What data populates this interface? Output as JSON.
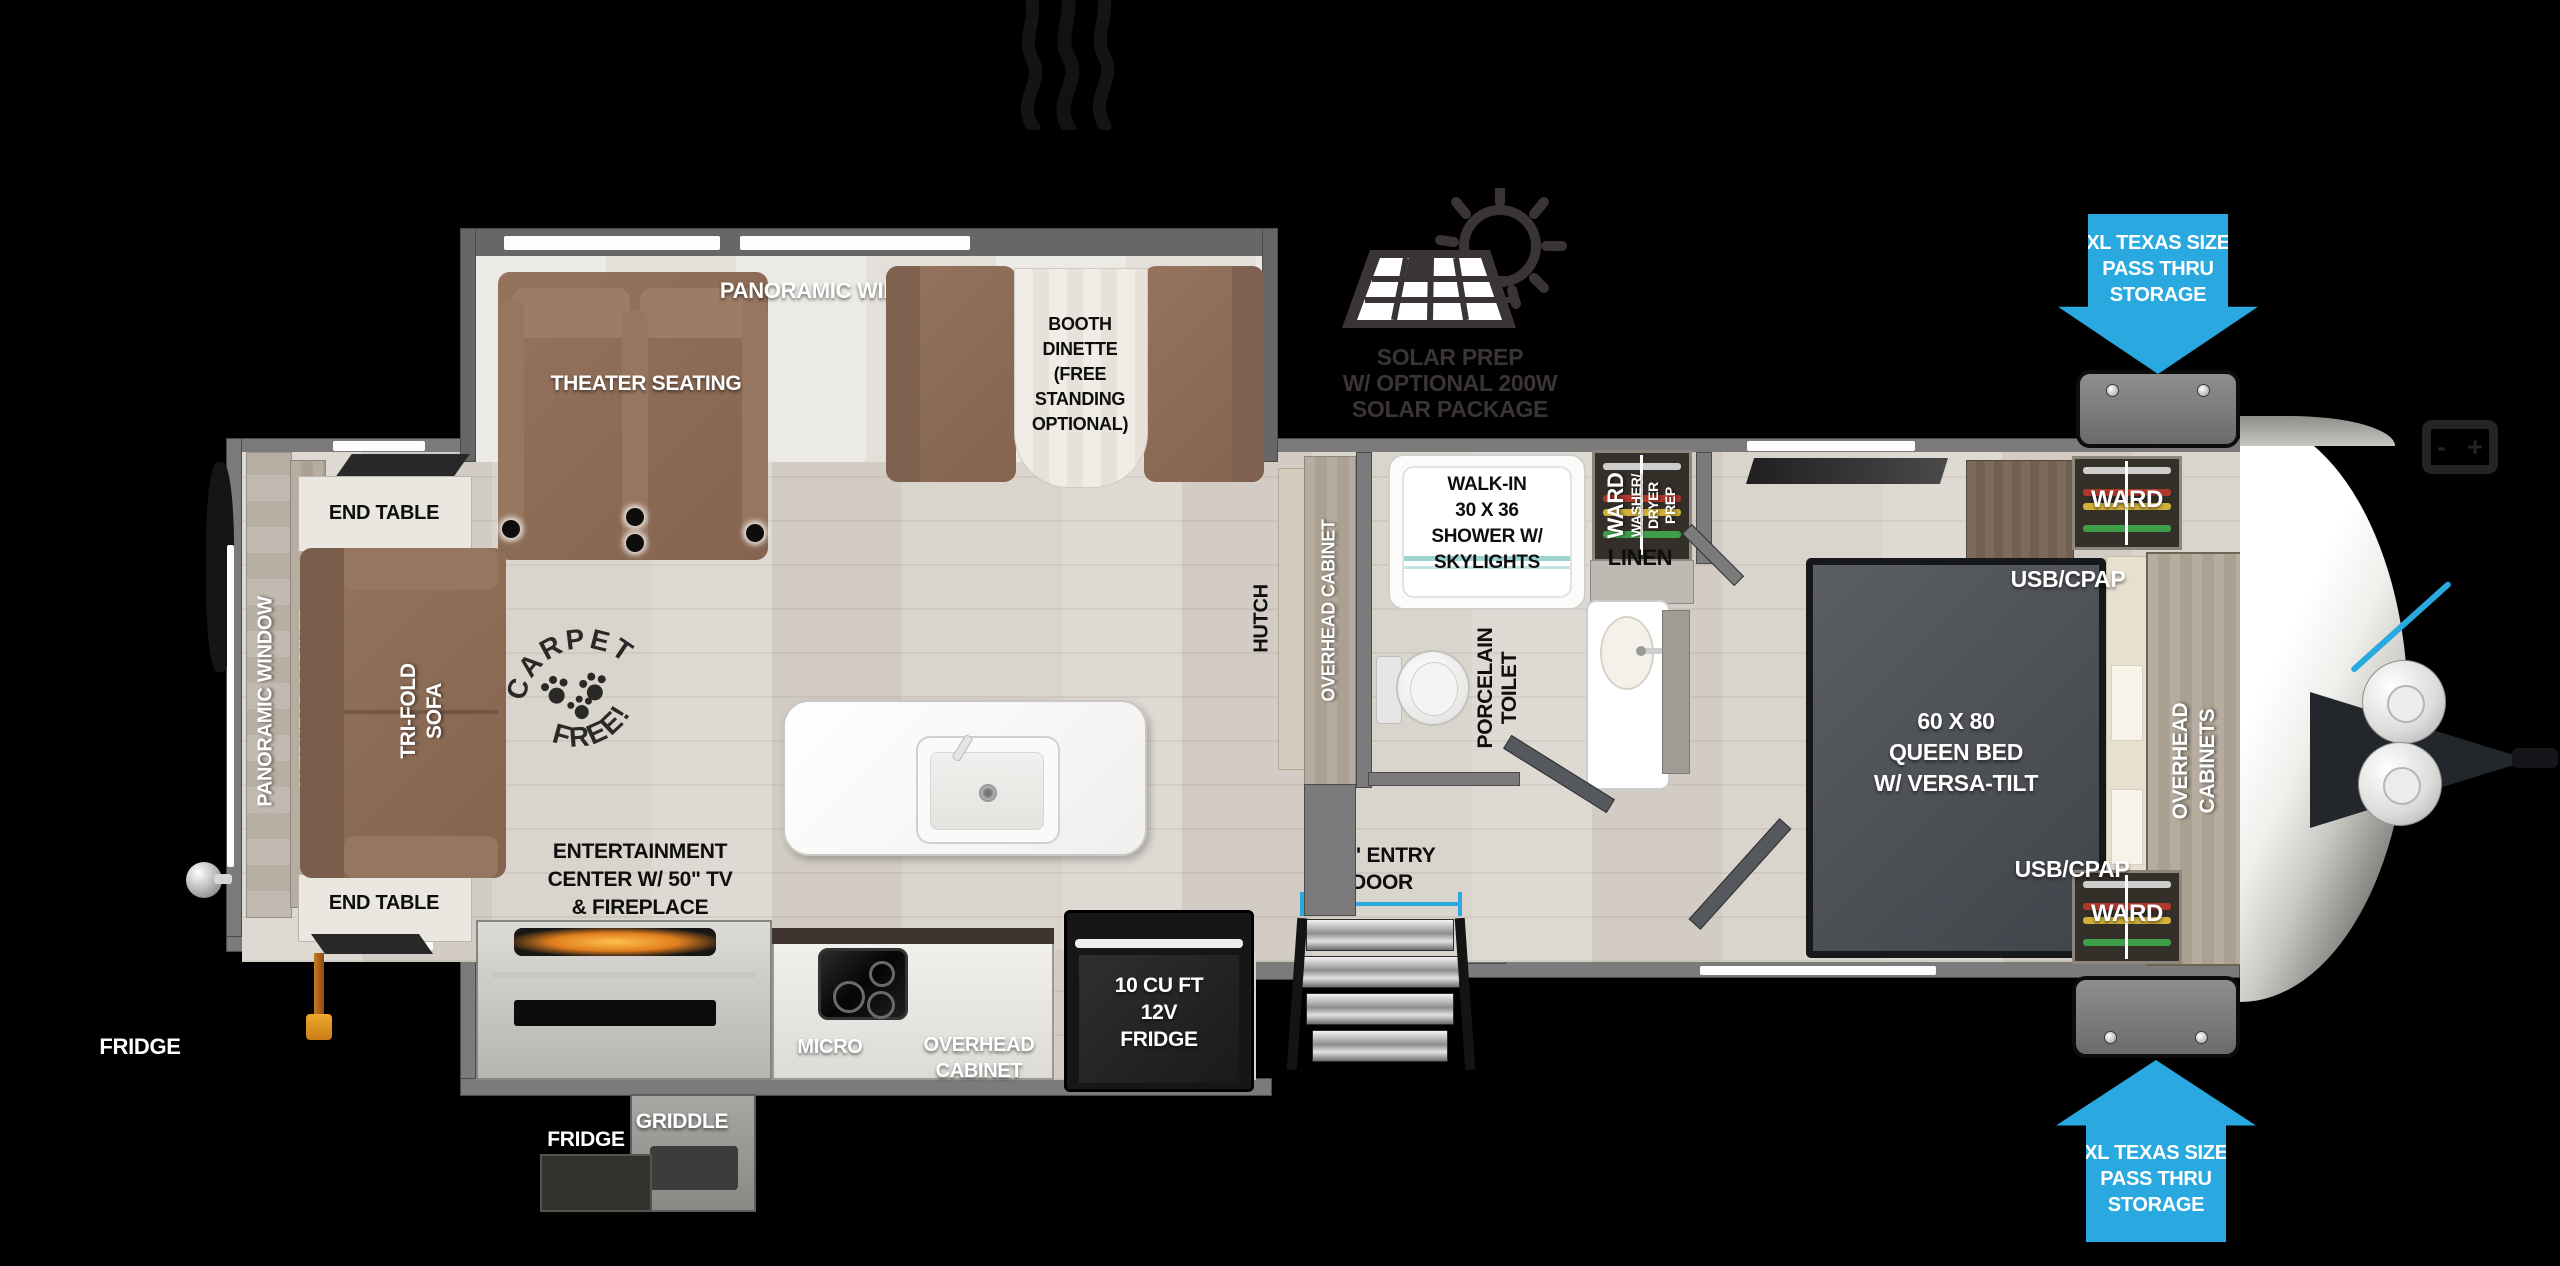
{
  "colors": {
    "accent_blue": "#29A9E0",
    "wall_gray": "#7B7B7B",
    "floor_wood": "#D8D3CC",
    "furniture_brown": "#8D6C58",
    "label_white": "#FFFFFF",
    "label_black": "#0E0E0E"
  },
  "slideout": {
    "panoramic_windows": "PANORAMIC WINDOWS",
    "theater_seating": "THEATER SEATING",
    "booth_dinette_lines": [
      "BOOTH",
      "DINETTE",
      "(FREE",
      "STANDING",
      "OPTIONAL)"
    ]
  },
  "solar": {
    "lines": [
      "SOLAR PREP",
      "W/ OPTIONAL 200W",
      "SOLAR PACKAGE"
    ]
  },
  "storage_arrow_top": {
    "lines": [
      "XL TEXAS SIZE",
      "PASS THRU",
      "STORAGE"
    ]
  },
  "storage_arrow_bottom": {
    "lines": [
      "XL TEXAS SIZE",
      "PASS THRU",
      "STORAGE"
    ]
  },
  "battery_icon": {
    "minus": "-",
    "plus": "+"
  },
  "bedroom": {
    "ward_top": "WARD",
    "ward_bottom": "WARD",
    "usb_cpap_top": "USB/CPAP",
    "usb_cpap_bottom": "USB/CPAP",
    "overhead_cabinets_lines": [
      "OVERHEAD",
      "CABINETS"
    ],
    "bed_lines": [
      "60 X  80",
      "QUEEN BED",
      "W/ VERSA-TILT"
    ]
  },
  "bathroom": {
    "shower_lines": [
      "WALK-IN",
      "30 X 36",
      "SHOWER W/",
      "SKYLIGHTS"
    ],
    "ward_washer_lines": [
      "WARD",
      "WASHER/",
      "DRYER",
      "PREP"
    ],
    "linen": "LINEN",
    "toilet_lines": [
      "PORCELAIN",
      "TOILET"
    ]
  },
  "kitchen": {
    "hutch": "HUTCH",
    "overhead_cabinet_wall": "OVERHEAD CABINET",
    "micro": "MICRO",
    "overhead_cabinet_lines": [
      "OVERHEAD",
      "CABINET"
    ],
    "fridge_12v_lines": [
      "10 CU FT",
      "12V",
      "FRIDGE"
    ],
    "entry_door_lines": [
      "30\" ENTRY",
      "DOOR"
    ],
    "griddle": "GRIDDLE",
    "outdoor_fridge": "FRIDGE"
  },
  "living": {
    "end_table_top": "END TABLE",
    "end_table_bottom": "END TABLE",
    "panoramic_window": "PANORAMIC WINDOW",
    "overhead_cabinet": "OVERHEAD CABINET",
    "sofa_lines": [
      "TRI-FOLD",
      "SOFA"
    ],
    "carpet_stamp": [
      "CARPET",
      "FREE!"
    ],
    "entertainment_lines": [
      "ENTERTAINMENT",
      "CENTER W/ 50\" TV",
      "& FIREPLACE"
    ],
    "rear_fridge": "FRIDGE"
  }
}
